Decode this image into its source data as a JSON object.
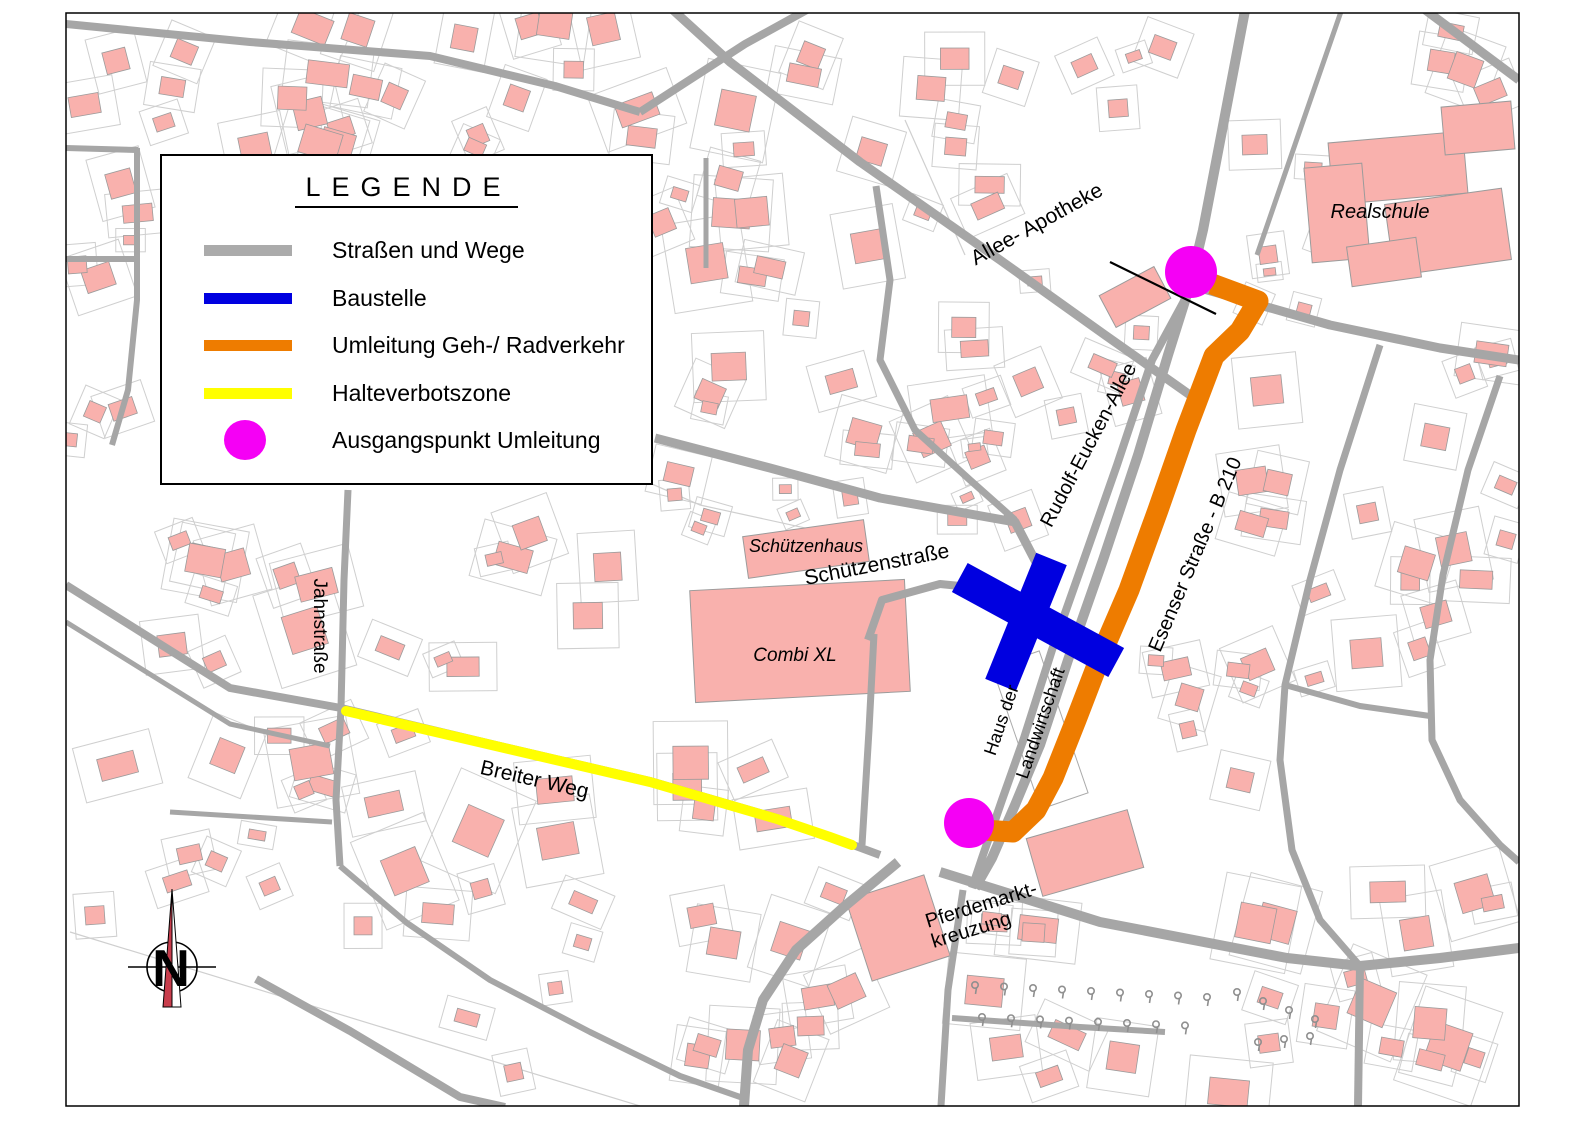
{
  "page": {
    "w": 1587,
    "h": 1122,
    "bg": "#ffffff"
  },
  "legend": {
    "title": "LEGENDE",
    "items": [
      {
        "id": "strassen",
        "type": "line",
        "color": "#ababab",
        "label": "Straßen und Wege"
      },
      {
        "id": "baustelle",
        "type": "line",
        "color": "#0000e0",
        "label": "Baustelle"
      },
      {
        "id": "umleitung",
        "type": "line",
        "color": "#ee7c00",
        "label": "Umleitung Geh-/ Radverkehr"
      },
      {
        "id": "halteverbot",
        "type": "line",
        "color": "#ffff00",
        "label": "Halteverbotszone"
      },
      {
        "id": "ausgangspunkt",
        "type": "dot",
        "color": "#f500f5",
        "label": "Ausgangspunkt Umleitung"
      }
    ]
  },
  "map": {
    "frame": {
      "x": 66,
      "y": 13,
      "w": 1453,
      "h": 1093,
      "border": "#000000"
    },
    "colors": {
      "road": "#a6a6a6",
      "building": "#f9b1ad",
      "buildingStroke": "#9b9b9b",
      "parcel": "#cfcfcf",
      "baustelle": "#0000e0",
      "umleitung": "#ee7c00",
      "halteverbot": "#ffff00",
      "punkt": "#f500f5",
      "tree": "#8f8f8f"
    },
    "seed": 1234,
    "roads": [
      {
        "w": 8,
        "pts": [
          [
            66,
            24
          ],
          [
            250,
            42
          ],
          [
            430,
            56
          ],
          [
            555,
            86
          ],
          [
            640,
            112
          ]
        ]
      },
      {
        "w": 8,
        "pts": [
          [
            825,
            0
          ],
          [
            745,
            44
          ],
          [
            640,
            112
          ]
        ]
      },
      {
        "w": 9,
        "pts": [
          [
            662,
            0
          ],
          [
            730,
            62
          ],
          [
            860,
            162
          ],
          [
            1000,
            260
          ],
          [
            1105,
            335
          ],
          [
            1190,
            395
          ]
        ]
      },
      {
        "w": 10,
        "pts": [
          [
            1247,
            0
          ],
          [
            1226,
            110
          ],
          [
            1203,
            230
          ],
          [
            1190,
            285
          ],
          [
            1168,
            355
          ],
          [
            1138,
            455
          ],
          [
            1103,
            560
          ],
          [
            1068,
            660
          ],
          [
            1040,
            745
          ],
          [
            1015,
            805
          ],
          [
            992,
            858
          ],
          [
            975,
            888
          ]
        ]
      },
      {
        "w": 8,
        "pts": [
          [
            1190,
            290
          ],
          [
            1152,
            360
          ],
          [
            1117,
            465
          ],
          [
            1082,
            565
          ],
          [
            1052,
            650
          ],
          [
            1024,
            738
          ],
          [
            1002,
            800
          ],
          [
            982,
            858
          ],
          [
            972,
            888
          ]
        ]
      },
      {
        "w": 9,
        "pts": [
          [
            1197,
            287
          ],
          [
            1330,
            325
          ],
          [
            1440,
            348
          ],
          [
            1519,
            360
          ]
        ]
      },
      {
        "w": 9,
        "pts": [
          [
            1412,
            0
          ],
          [
            1519,
            80
          ]
        ]
      },
      {
        "w": 5,
        "pts": [
          [
            1345,
            0
          ],
          [
            1300,
            130
          ],
          [
            1257,
            255
          ]
        ]
      },
      {
        "w": 7,
        "pts": [
          [
            876,
            186
          ],
          [
            890,
            280
          ],
          [
            880,
            360
          ],
          [
            915,
            430
          ],
          [
            970,
            480
          ],
          [
            1015,
            520
          ]
        ]
      },
      {
        "w": 9,
        "pts": [
          [
            655,
            438
          ],
          [
            770,
            468
          ],
          [
            880,
            498
          ],
          [
            1015,
            522
          ],
          [
            1040,
            570
          ],
          [
            1042,
            605
          ]
        ]
      },
      {
        "w": 8,
        "pts": [
          [
            868,
            640
          ],
          [
            882,
            600
          ],
          [
            940,
            584
          ],
          [
            1000,
            590
          ],
          [
            1048,
            620
          ],
          [
            1070,
            642
          ]
        ]
      },
      {
        "w": 7,
        "pts": [
          [
            874,
            634
          ],
          [
            869,
            730
          ],
          [
            862,
            845
          ]
        ]
      },
      {
        "w": 7,
        "pts": [
          [
            348,
            490
          ],
          [
            344,
            580
          ],
          [
            341,
            708
          ],
          [
            336,
            800
          ],
          [
            340,
            866
          ]
        ]
      },
      {
        "w": 8,
        "pts": [
          [
            66,
            585
          ],
          [
            230,
            688
          ],
          [
            341,
            708
          ]
        ]
      },
      {
        "w": 5,
        "pts": [
          [
            66,
            622
          ],
          [
            230,
            724
          ],
          [
            330,
            746
          ]
        ]
      },
      {
        "w": 8,
        "pts": [
          [
            341,
            708
          ],
          [
            500,
            746
          ],
          [
            650,
            781
          ],
          [
            777,
            818
          ],
          [
            853,
            845
          ],
          [
            880,
            855
          ]
        ]
      },
      {
        "w": 5,
        "pts": [
          [
            170,
            812
          ],
          [
            332,
            822
          ]
        ]
      },
      {
        "w": 8,
        "pts": [
          [
            256,
            979
          ],
          [
            350,
            1031
          ],
          [
            460,
            1097
          ],
          [
            505,
            1107
          ]
        ]
      },
      {
        "w": 6,
        "pts": [
          [
            340,
            866
          ],
          [
            407,
            923
          ],
          [
            490,
            980
          ],
          [
            590,
            1032
          ],
          [
            680,
            1076
          ],
          [
            743,
            1098
          ]
        ]
      },
      {
        "w": 10,
        "pts": [
          [
            898,
            862
          ],
          [
            845,
            906
          ],
          [
            796,
            950
          ],
          [
            763,
            1000
          ],
          [
            748,
            1050
          ],
          [
            744,
            1106
          ]
        ]
      },
      {
        "w": 10,
        "pts": [
          [
            940,
            872
          ],
          [
            1100,
            922
          ],
          [
            1287,
            958
          ],
          [
            1360,
            966
          ],
          [
            1440,
            958
          ],
          [
            1519,
            948
          ]
        ]
      },
      {
        "w": 8,
        "pts": [
          [
            1360,
            966
          ],
          [
            1358,
            1106
          ]
        ]
      },
      {
        "w": 7,
        "pts": [
          [
            963,
            890
          ],
          [
            948,
            990
          ],
          [
            941,
            1106
          ]
        ]
      },
      {
        "w": 6,
        "pts": [
          [
            952,
            1018
          ],
          [
            1080,
            1027
          ],
          [
            1165,
            1032
          ]
        ]
      },
      {
        "w": 7,
        "pts": [
          [
            1380,
            345
          ],
          [
            1340,
            470
          ],
          [
            1310,
            580
          ],
          [
            1285,
            685
          ],
          [
            1280,
            760
          ],
          [
            1292,
            850
          ],
          [
            1320,
            920
          ],
          [
            1360,
            966
          ]
        ]
      },
      {
        "w": 6,
        "pts": [
          [
            1285,
            685
          ],
          [
            1360,
            706
          ],
          [
            1430,
            716
          ]
        ]
      },
      {
        "w": 7,
        "pts": [
          [
            1500,
            376
          ],
          [
            1468,
            470
          ],
          [
            1443,
            575
          ],
          [
            1430,
            660
          ],
          [
            1432,
            740
          ],
          [
            1460,
            800
          ],
          [
            1500,
            845
          ],
          [
            1519,
            862
          ]
        ]
      },
      {
        "w": 6,
        "pts": [
          [
            66,
            148
          ],
          [
            138,
            150
          ]
        ]
      },
      {
        "w": 6,
        "pts": [
          [
            137,
            148
          ],
          [
            137,
            300
          ],
          [
            128,
            390
          ],
          [
            112,
            445
          ]
        ]
      },
      {
        "w": 6,
        "pts": [
          [
            66,
            259
          ],
          [
            137,
            259
          ]
        ]
      },
      {
        "w": 5,
        "pts": [
          [
            706,
            158
          ],
          [
            706,
            268
          ]
        ]
      }
    ],
    "parcelLines": [
      [
        [
          70,
          932
        ],
        [
          640,
          1106
        ]
      ],
      [
        [
          905,
          120
        ],
        [
          965,
          255
        ]
      ],
      [
        [
          620,
          470
        ],
        [
          700,
          505
        ],
        [
          860,
          540
        ]
      ]
    ],
    "routes": {
      "halteverbot": {
        "w": 10,
        "pts": [
          [
            346,
            711
          ],
          [
            500,
            747
          ],
          [
            650,
            782
          ],
          [
            777,
            819
          ],
          [
            830,
            837
          ],
          [
            852,
            845
          ]
        ]
      },
      "umleitung": {
        "w": 21,
        "pts": [
          [
            1212,
            284
          ],
          [
            1258,
            301
          ],
          [
            1240,
            331
          ],
          [
            1214,
            356
          ],
          [
            1186,
            430
          ],
          [
            1158,
            510
          ],
          [
            1129,
            590
          ],
          [
            1101,
            655
          ],
          [
            1076,
            720
          ],
          [
            1053,
            778
          ],
          [
            1036,
            810
          ],
          [
            1013,
            832
          ],
          [
            983,
            830
          ]
        ]
      },
      "baustelle": [
        {
          "cx": 1038,
          "cy": 620,
          "len": 178,
          "w": 33,
          "rot": 28.5
        },
        {
          "cx": 1026,
          "cy": 622,
          "len": 136,
          "w": 33,
          "rot": 112
        }
      ],
      "punkte": [
        {
          "x": 1191,
          "y": 272,
          "r": 26
        },
        {
          "x": 969,
          "y": 823,
          "r": 25
        }
      ],
      "leader": [
        [
          1110,
          262
        ],
        [
          1216,
          314
        ]
      ]
    },
    "namedBuildings": [
      {
        "x": 800,
        "y": 641,
        "w": 215,
        "h": 112,
        "rot": -3
      },
      {
        "x": 806,
        "y": 549,
        "w": 122,
        "h": 42,
        "rot": -8
      },
      {
        "x": 1398,
        "y": 168,
        "w": 135,
        "h": 62,
        "rot": -5
      },
      {
        "x": 1448,
        "y": 232,
        "w": 118,
        "h": 72,
        "rot": -8
      },
      {
        "x": 1337,
        "y": 213,
        "w": 58,
        "h": 95,
        "rot": -5
      },
      {
        "x": 1478,
        "y": 128,
        "w": 70,
        "h": 48,
        "rot": -5
      },
      {
        "x": 1384,
        "y": 262,
        "w": 70,
        "h": 40,
        "rot": -8
      },
      {
        "x": 1135,
        "y": 297,
        "w": 62,
        "h": 36,
        "rot": -28
      },
      {
        "x": 1085,
        "y": 853,
        "w": 105,
        "h": 60,
        "rot": -16
      },
      {
        "x": 898,
        "y": 928,
        "w": 82,
        "h": 85,
        "rot": -18
      }
    ],
    "whiteParcels": [
      {
        "x": 1040,
        "y": 730,
        "w": 50,
        "h": 150,
        "rot": -19
      }
    ],
    "clusters": [
      [
        70,
        18,
        580,
        130,
        26,
        16,
        42
      ],
      [
        68,
        160,
        88,
        330,
        8,
        14,
        30
      ],
      [
        660,
        40,
        290,
        440,
        26,
        14,
        38
      ],
      [
        945,
        25,
        100,
        225,
        6,
        14,
        30
      ],
      [
        1050,
        40,
        130,
        80,
        4,
        12,
        24
      ],
      [
        1245,
        120,
        80,
        200,
        7,
        12,
        26
      ],
      [
        1430,
        30,
        85,
        90,
        4,
        16,
        30
      ],
      [
        1240,
        350,
        270,
        330,
        22,
        16,
        40
      ],
      [
        165,
        495,
        480,
        195,
        18,
        16,
        40
      ],
      [
        900,
        430,
        150,
        105,
        7,
        12,
        26
      ],
      [
        90,
        730,
        760,
        210,
        30,
        16,
        42
      ],
      [
        380,
        940,
        480,
        150,
        14,
        14,
        34
      ],
      [
        980,
        880,
        530,
        215,
        26,
        16,
        40
      ],
      [
        1100,
        660,
        150,
        190,
        7,
        14,
        30
      ],
      [
        950,
        280,
        200,
        150,
        10,
        12,
        28
      ],
      [
        660,
        485,
        200,
        80,
        6,
        12,
        24
      ]
    ],
    "trees": [
      {
        "x0": 975,
        "y0": 985,
        "dx": 29,
        "dy": 1.5,
        "n": 9
      },
      {
        "x0": 982,
        "y0": 1017,
        "dx": 29,
        "dy": 1.2,
        "n": 8
      },
      {
        "x0": 1237,
        "y0": 992,
        "dx": 26,
        "dy": 9,
        "n": 4
      },
      {
        "x0": 1258,
        "y0": 1042,
        "dx": 26,
        "dy": -3,
        "n": 3
      }
    ],
    "labels": [
      {
        "id": "allee-apotheke",
        "text": "Allee- Apotheke",
        "x": 1040,
        "y": 230,
        "rot": -29,
        "size": 21
      },
      {
        "id": "realschule",
        "text": "Realschule",
        "x": 1380,
        "y": 218,
        "rot": 0,
        "size": 20,
        "italic": true
      },
      {
        "id": "rudolf-eucken-allee",
        "text": "Rudolf-Eucken-Allee",
        "x": 1094,
        "y": 448,
        "rot": -62,
        "size": 20
      },
      {
        "id": "esenser-strasse",
        "text": "Esenser Straße - B 210",
        "x": 1201,
        "y": 557,
        "rot": -67,
        "size": 20
      },
      {
        "id": "schuetzenhaus",
        "text": "Schützenhaus",
        "x": 806,
        "y": 552,
        "rot": 0,
        "size": 18,
        "italic": true
      },
      {
        "id": "schuetzenstrasse",
        "text": "Schützenstraße",
        "x": 878,
        "y": 571,
        "rot": -11,
        "size": 21
      },
      {
        "id": "combi-xl",
        "text": "Combi XL",
        "x": 795,
        "y": 661,
        "rot": 0,
        "size": 19,
        "italic": true
      },
      {
        "id": "jahnstrasse",
        "text": "Jahnstraße",
        "x": 314,
        "y": 626,
        "rot": 90,
        "size": 19
      },
      {
        "id": "breiter-weg",
        "text": "Breiter Weg",
        "x": 533,
        "y": 786,
        "rot": 13,
        "size": 21
      },
      {
        "id": "haus-der",
        "text": "Haus der",
        "x": 1007,
        "y": 722,
        "rot": -71,
        "size": 18
      },
      {
        "id": "landwirtschaft",
        "text": "Landwirtschaft",
        "x": 1046,
        "y": 725,
        "rot": -71,
        "size": 18
      },
      {
        "id": "pferdemarkt-1",
        "text": "Pferdemarkt-",
        "x": 983,
        "y": 911,
        "rot": -17,
        "size": 20
      },
      {
        "id": "pferdemarkt-2",
        "text": "kreuzung",
        "x": 973,
        "y": 936,
        "rot": -17,
        "size": 20
      }
    ],
    "north": {
      "x": 172,
      "y": 967,
      "letter": "N"
    }
  }
}
